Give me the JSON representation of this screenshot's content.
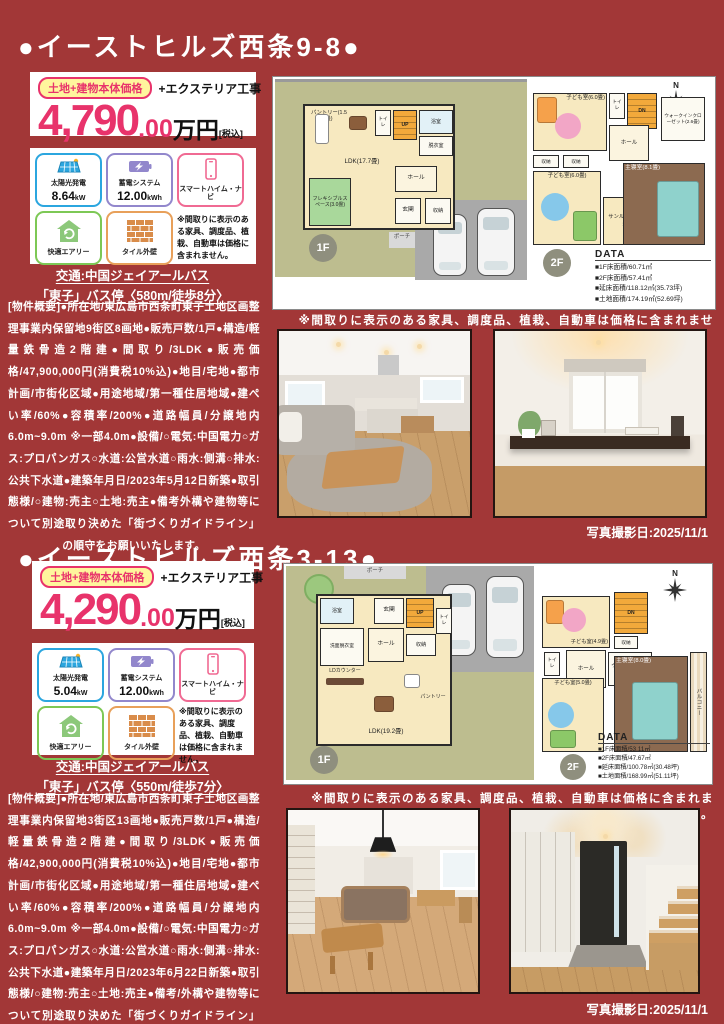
{
  "colors": {
    "bg": "#A23737",
    "accent-pink": "#E8336B",
    "badge-yellow": "#FFF59D",
    "site-olive": "#BDBD8F",
    "room-cream": "#F7E9C0",
    "stair-orange": "#F2A93B",
    "master-brown": "#8C6A50"
  },
  "sections": [
    {
      "title": "●イーストヒルズ西条9-8●",
      "price": {
        "badge": "土地+建物本体価格",
        "plus": "+エクステリア工事",
        "amount": "4,790",
        "decimal": ".00",
        "unit": "万円",
        "tax": "[税込]"
      },
      "features": {
        "solar_label": "太陽光発電",
        "solar_value": "8.64",
        "solar_unit": "kW",
        "battery_label": "蓄電システム",
        "battery_value": "12.00",
        "battery_unit": "kWh",
        "navi_label": "スマートハイム・ナビ",
        "airy_label": "快適エアリー",
        "tile_label": "タイル外壁",
        "note": "※間取りに表示のある家具、調度品、植栽、自動車は価格に含まれません。"
      },
      "transit": {
        "line1": "交通:中国ジェイアールバス",
        "line2": "「東子」バス停〈580m/徒歩8分〉"
      },
      "description": "[物件概要]●所在地/東広島市西条町東子土地区画整理事業内保留地9街区8画地●販売戸数/1戸●構造/軽量鉄骨造2階建●間取り/3LDK●販売価格/47,900,000円(消費税10%込)●地目/宅地●都市計画/市街化区域●用途地域/第一種住居地域●建ぺい率/60%●容積率/200%●道路幅員/分譲地内6.0m~9.0m ※一部4.0m●設備/○電気:中国電力○ガス:プロパンガス○水道:公営水道○雨水:側溝○排水:公共下水道●建築年月日/2023年5月12日新築●取引態様/○建物:売主○土地:売主●備考外構や建物等について別途取り決めた「街づくりガイドライン」の順守をお願いいたします。",
      "plan": {
        "badge_1f": "1F",
        "badge_2f": "2F",
        "north": "N",
        "data_title": "DATA",
        "data_rows": [
          "■1F床面積/60.71㎡",
          "■2F床面積/57.41㎡",
          "■延床面積/118.12㎡(35.73坪)",
          "■土地面積/174.19㎡(52.69坪)"
        ],
        "rooms_1f": {
          "ldk": "LDK(17.7畳)",
          "flex": "フレキシブルスペース(3.0畳)",
          "pantry": "パントリー(1.5畳)",
          "hall": "ホール",
          "entrance": "玄関",
          "storage": "収納",
          "porch": "ポーチ",
          "bath": "浴室",
          "wash": "脱衣室",
          "toilet": "トイレ",
          "stairs": "UP"
        },
        "rooms_2f": {
          "kids1": "子ども室(6.0畳)",
          "kids2": "子ども室(6.0畳)",
          "sunroom": "サンルーム(2.9畳)",
          "master": "主寝室(8.1畳)",
          "wic": "ウォークインクローゼット(2.6畳)",
          "hall": "ホール",
          "toilet": "トイレ",
          "stairs": "DN",
          "storage": "収納"
        },
        "note": "※間取りに表示のある家具、調度品、植栽、自動車は価格に含まれません。"
      },
      "photo_caption": "写真撮影日:2025/11/1"
    },
    {
      "title": "●イーストヒルズ西条3-13●",
      "price": {
        "badge": "土地+建物本体価格",
        "plus": "+エクステリア工事",
        "amount": "4,290",
        "decimal": ".00",
        "unit": "万円",
        "tax": "[税込]"
      },
      "features": {
        "solar_label": "太陽光発電",
        "solar_value": "5.04",
        "solar_unit": "kW",
        "battery_label": "蓄電システム",
        "battery_value": "12.00",
        "battery_unit": "kWh",
        "navi_label": "スマートハイム・ナビ",
        "airy_label": "快適エアリー",
        "tile_label": "タイル外壁",
        "note": "※間取りに表示のある家具、調度品、植栽、自動車は価格に含まれません。"
      },
      "transit": {
        "line1": "交通:中国ジェイアールバス",
        "line2": "「東子」バス停〈550m/徒歩7分〉"
      },
      "description": "[物件概要]●所在地/東広島市西条町東子土地区画整理事業内保留地3街区13画地●販売戸数/1戸●構造/軽量鉄骨造2階建●間取り/3LDK●販売価格/42,900,000円(消費税10%込)●地目/宅地●都市計画/市街化区域●用途地域/第一種住居地域●建ぺい率/60%●容積率/200%●道路幅員/分譲地内6.0m~9.0m ※一部4.0m●設備/○電気:中国電力○ガス:プロパンガス○水道:公営水道○雨水:側溝○排水:公共下水道●建築年月日/2023年6月22日新築●取引態様/○建物:売主○土地:売主●備考/外構や建物等について別途取り決めた「街づくりガイドライン」の順守をお願いいたします。",
      "plan": {
        "badge_1f": "1F",
        "badge_2f": "2F",
        "north": "N",
        "data_title": "DATA",
        "data_rows": [
          "■1F床面積/53.11㎡",
          "■2F床面積/47.67㎡",
          "■延床面積/100.78㎡(30.48坪)",
          "■土地面積/168.99㎡(51.11坪)"
        ],
        "rooms_1f": {
          "ldk": "LDK(19.2畳)",
          "counter": "LDカウンター",
          "pantry": "パントリー",
          "hall": "ホール",
          "entrance": "玄関",
          "storage": "収納",
          "porch": "ポーチ",
          "bath": "浴室",
          "wash": "洗面脱衣室",
          "toilet": "トイレ",
          "stairs": "UP"
        },
        "rooms_2f": {
          "kids1": "子ども室(4.9畳)",
          "kids2": "子ども室(5.0畳)",
          "wic": "ウォークインクローゼット(3.9畳)",
          "master": "主寝室(8.0畳)",
          "balcony": "バルコニー",
          "hall": "ホール",
          "toilet": "トイレ",
          "stairs": "DN",
          "storage": "収納"
        },
        "note": "※間取りに表示のある家具、調度品、植栽、自動車は価格に含まれません。"
      },
      "photo_caption": "写真撮影日:2025/11/1"
    }
  ]
}
